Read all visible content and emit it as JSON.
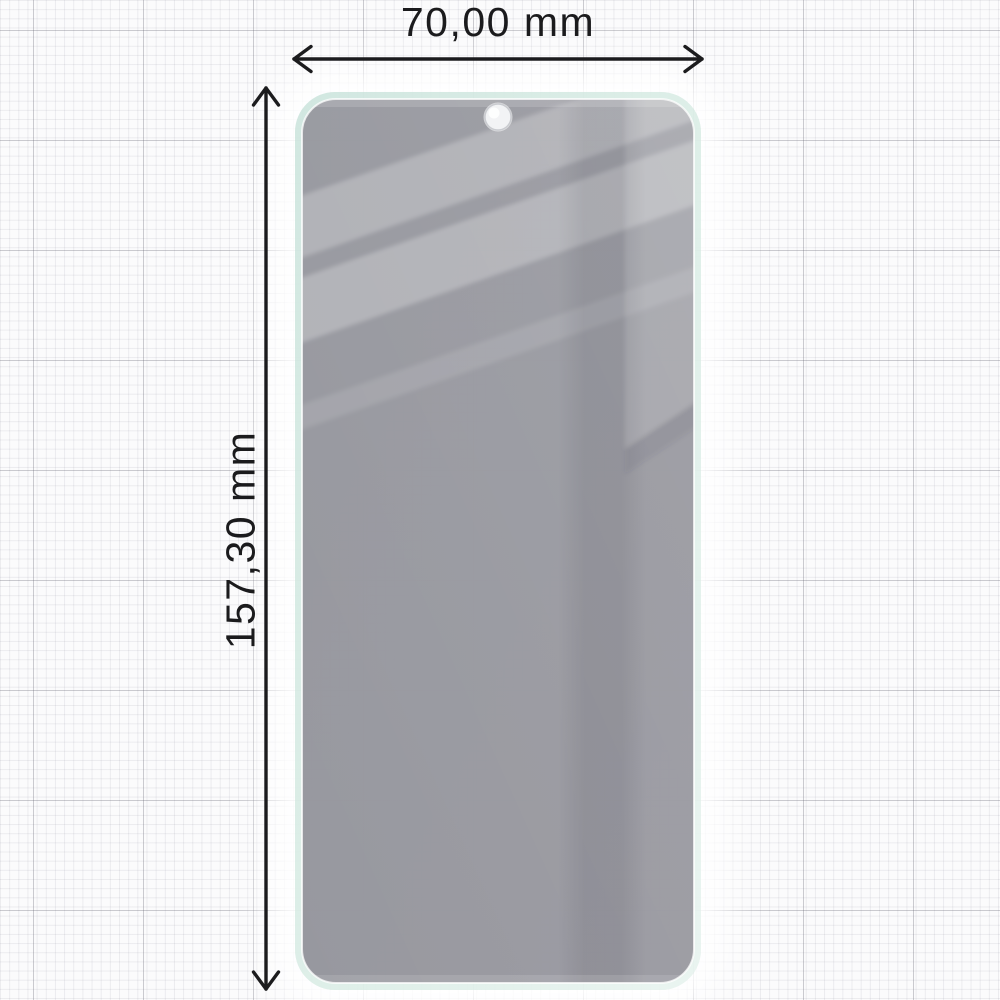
{
  "page": {
    "type": "product-dimension-diagram",
    "product": "privacy tempered glass screen protector"
  },
  "dimensions": {
    "width": {
      "label": "70,00 mm",
      "orientation": "horizontal"
    },
    "height": {
      "label": "157,30 mm",
      "orientation": "vertical"
    }
  },
  "icons": {
    "camera_hole": "punch-hole-camera-cutout",
    "width_arrow": "double-headed-horizontal-arrow",
    "height_arrow": "double-headed-vertical-arrow"
  },
  "colors": {
    "background_paper": "#fbfbfc",
    "grid_minor": "#e9e9ee",
    "grid_major": "#c6c6cc",
    "dimension_line": "#1c1c1e",
    "label_text": "#1b1b1d",
    "glass_tint": "#9d9aa3",
    "glass_reflection": "#b5b3ba",
    "glass_dark_strip": "#8f8c95",
    "edge_mint": "#d6e9e2",
    "camera_hole_fill": "#f2f3f5"
  }
}
